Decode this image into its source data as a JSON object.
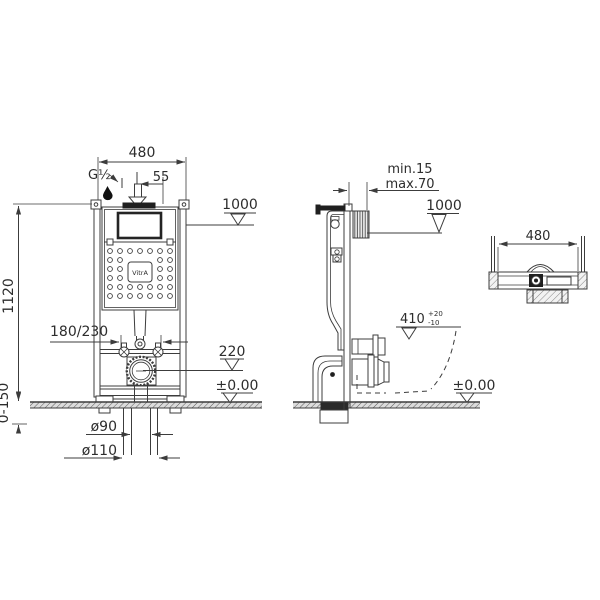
{
  "colors": {
    "line": "#3c3c3c",
    "text": "#2d2d2d",
    "dark_fill": "#1f1f1f",
    "floor_fill": "#dcdcdc",
    "background": "#ffffff"
  },
  "brand": "VitrA",
  "front": {
    "width": "480",
    "inlet_thread": "G½",
    "inlet_offset": "55",
    "flush_plate_level": "1000",
    "frame_height": "1120",
    "fixing_bolt_spacing": "180/230",
    "outlet_height": "220",
    "floor_level": "±0.00",
    "foot_adjustment": "0-150",
    "outlet_diameter": "ø90",
    "sleeve_diameter": "ø110"
  },
  "side": {
    "wall_distance_min": "min.15",
    "wall_distance_max": "max.70",
    "flush_plate_level": "1000",
    "rim_level": "410",
    "rim_tolerance_plus": "+20",
    "rim_tolerance_minus": "-10",
    "floor_level": "±0.00"
  },
  "top": {
    "width": "480"
  },
  "icons": {
    "water_drop_icon": "water supply inlet",
    "down_arrow_icon": "inlet direction",
    "level_triangle_icon": "datum level marker"
  }
}
